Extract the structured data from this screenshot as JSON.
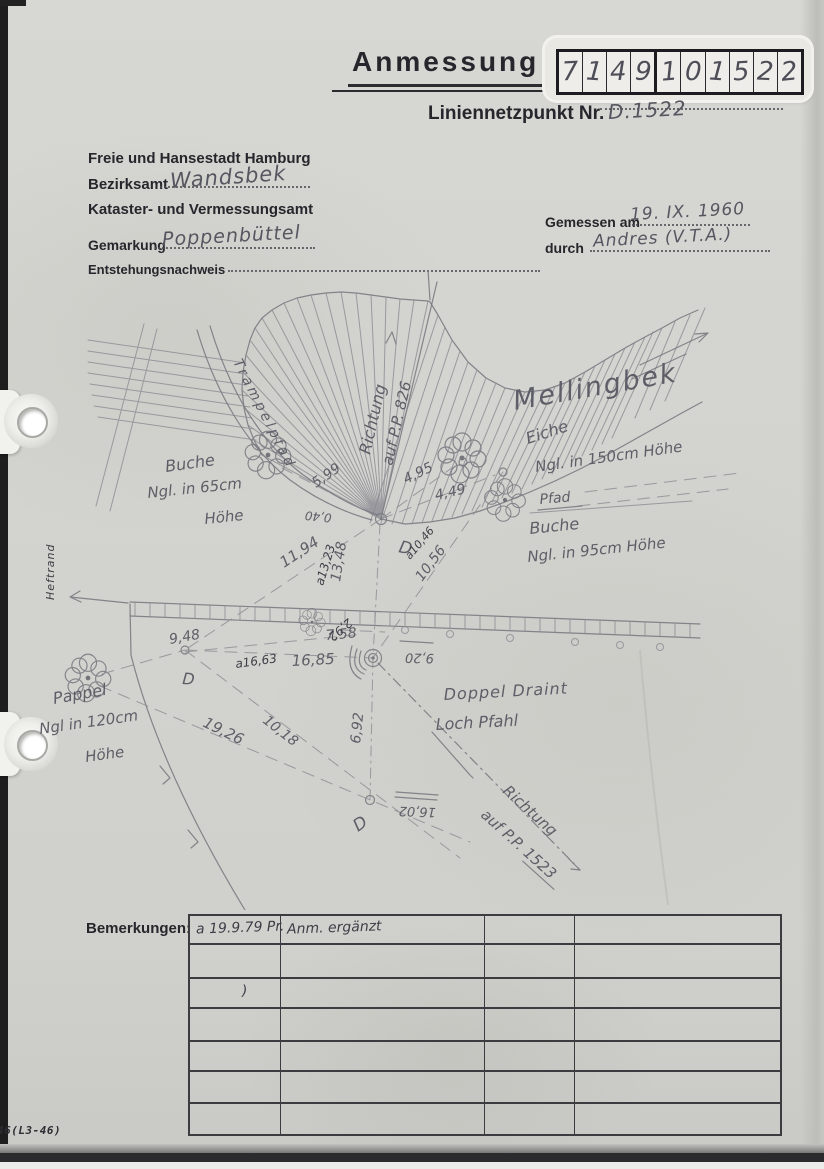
{
  "form": {
    "title": "Anmessung",
    "point_number_boxes": [
      "7",
      "1",
      "4",
      "9",
      "1",
      "0",
      "1",
      "5",
      "2",
      "2"
    ],
    "liniennetzpunkt_label": "Liniennetzpunkt Nr.",
    "liniennetzpunkt_value": "D.1522",
    "agency_line1": "Freie und Hansestadt Hamburg",
    "bezirksamt_label": "Bezirksamt",
    "bezirksamt_value": "Wandsbek",
    "agency_line3": "Kataster- und Vermessungsamt",
    "gemarkung_label": "Gemarkung",
    "gemarkung_value": "Poppenbüttel",
    "entstehungsnachweis_label": "Entstehungsnachweis",
    "gemessen_am_label": "Gemessen am",
    "gemessen_am_value": "19. IX. 1960",
    "durch_label": "durch",
    "durch_value": "Andres (V.T.A.)"
  },
  "sketch": {
    "stream_name": "Mellingbek",
    "direction_826": [
      "Richtung",
      "auf P.P. 826"
    ],
    "path_label": "Trampelpfad",
    "tree_buche65": [
      "Buche",
      "Ngl. in 65cm",
      "Höhe"
    ],
    "tree_eiche150": [
      "Eiche",
      "Ngl. in 150cm Höhe"
    ],
    "pfad_label": "Pfad",
    "tree_buche95": [
      "Buche",
      "Ngl. in 95cm Höhe"
    ],
    "tree_pappel120": [
      "Pappel",
      "Ngl in 120cm",
      "Höhe"
    ],
    "point_label": [
      "Doppel Draint",
      "Loch Pfahl"
    ],
    "direction_1523": [
      "Richtung",
      "auf P.P. 1523"
    ],
    "d_marks": [
      "D",
      "D",
      "D"
    ],
    "measurements": {
      "m599": "5,99",
      "m495": "4,95",
      "m449": "4,49",
      "m040": "0,40",
      "m1194": "11,94",
      "m1348": "13,48",
      "m1056": "10,56",
      "m948": "9,48",
      "m758": "7,58",
      "m1685": "16,85",
      "m292": "2,92",
      "m920": "9,20",
      "m1018": "10,18",
      "m1926": "19,26",
      "m692": "6,92",
      "m1602": "16,02"
    },
    "pen_annotations": {
      "a1323": "a13,23",
      "a1046": "a10,46",
      "a1663": "a16,63"
    }
  },
  "remarks": {
    "label": "Bemerkungen:",
    "entries": [
      {
        "row": 0,
        "col": 0,
        "text": "a 19.9.79 Pr."
      },
      {
        "row": 0,
        "col": 1,
        "text": "Anm. ergänzt"
      },
      {
        "row": 2,
        "col": 0,
        "text": ")"
      }
    ]
  },
  "margin": {
    "heftrand": "Heftrand",
    "form_code": "46(L3-46)"
  },
  "colors": {
    "paper": "#d3d3cf",
    "pencil": "#7a7a82",
    "pen": "#3e3e48",
    "print": "#26262c"
  }
}
